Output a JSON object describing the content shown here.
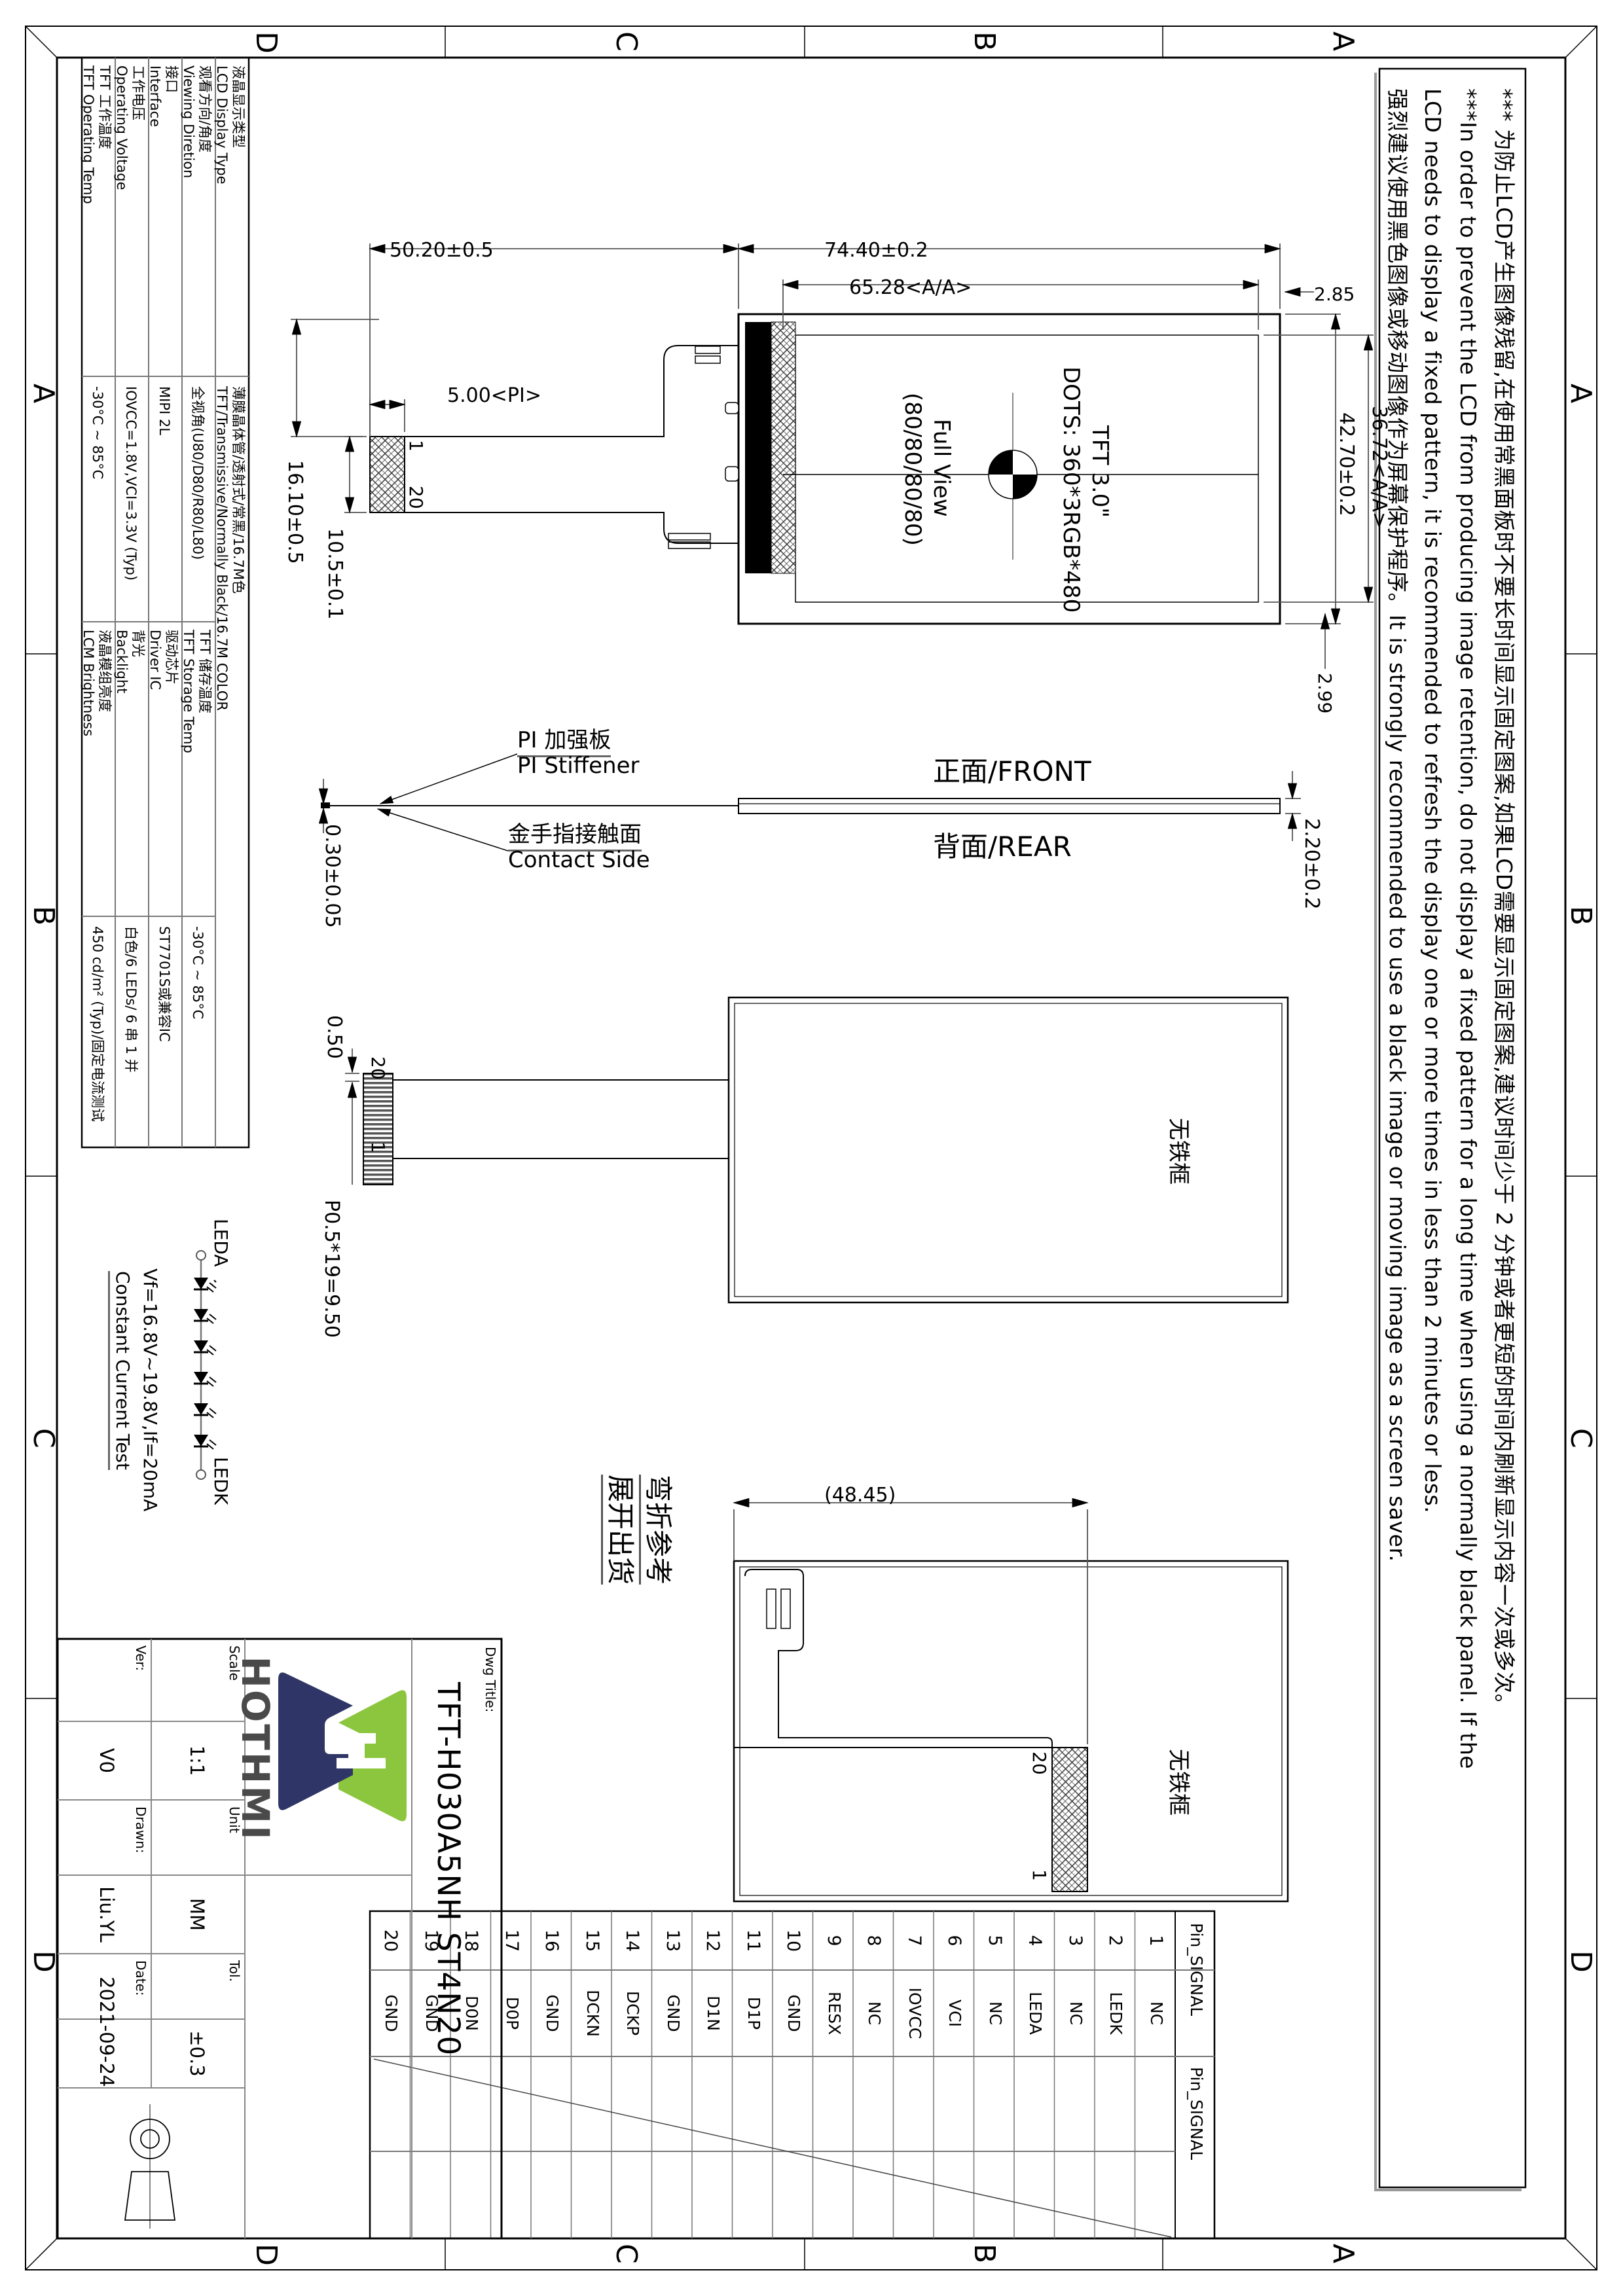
{
  "zones": {
    "z1": "A",
    "z2": "B",
    "z3": "C",
    "z4": "D"
  },
  "note": {
    "line1": "*** 为防止LCD产生图像残留,在使用常黑面板时不要长时间显示固定图案,如果LCD需要显示固定图案,建议时间少于 2 分钟或者更短的时间内刷新显示内容一次或多次。",
    "line2": "***In order to prevent the LCD from producing image retention, do not display a fixed pattern for a long time when using a normally black panel. If the",
    "line3": "LCD needs to display a fixed pattern, it is recommended to refresh the display one or more times in less than 2 minutes or less.",
    "line4": "强烈建议使用黑色图像或移动图像作为屏幕保护程序。It is strongly recommended to use a black image or moving image as a screen saver."
  },
  "specs": {
    "r1": {
      "l_cn": "液晶显示类型",
      "l_en": "LCD Display Type",
      "v_cn": "薄膜晶体管/透射式/常黑/16.7M色",
      "v_en": "TFT/Transmissive/Normally Black/16.7M COLOR"
    },
    "r2": {
      "l_cn": "观看方向/角度",
      "l_en": "Viewing Diretion",
      "v": "全视角(U80/D80/R80/L80)",
      "l2_cn": "TFT 储存温度",
      "l2_en": "TFT Storage Temp",
      "v2": "-30°C ~ 85°C"
    },
    "r3": {
      "l_cn": "接口",
      "l_en": "Interface",
      "v": "MIPI 2L",
      "l2_cn": "驱动芯片",
      "l2_en": "Driver IC",
      "v2": "ST7701S或兼容IC"
    },
    "r4": {
      "l_cn": "工作电压",
      "l_en": "Operating Voltage",
      "v": "IOVCC=1.8V,VCI=3.3V (Typ)",
      "l2_cn": "背光",
      "l2_en": "Backlight",
      "v2": "白色/6 LEDs/ 6 串 1 并"
    },
    "r5": {
      "l_cn": "TFT 工作温度",
      "l_en": "TFT Operating Temp",
      "v": "-30°C ~ 85°C",
      "l2_cn": "液晶模组亮度",
      "l2_en": "LCM Brightness",
      "v2": "450 cd/m² (Typ)/固定电流测试"
    }
  },
  "dims": {
    "d5020": "50.20±0.5",
    "d7440": "74.40±0.2",
    "d6528": "65.28<A/A>",
    "d285": "2.85",
    "d4270": "42.70±0.2",
    "d3672": "36.72<A/A>",
    "d299": "2.99",
    "d1610": "16.10±0.5",
    "d105": "10.5±0.1",
    "d500": "5.00<PI>",
    "d030": "0.30±0.05",
    "d220": "2.20±0.2",
    "d050": "0.50",
    "pitch": "P0.5*19=9.50",
    "d4845": "(48.45)"
  },
  "front": {
    "tft": "TFT 3.0\"",
    "dots": "DOTS: 360*3RGB*480",
    "fv1": "Full View",
    "fv2": "(80/80/80/80)",
    "pin1": "1",
    "pin20": "20"
  },
  "side": {
    "pi_cn": "PI 加强板",
    "pi_en": "PI Stiffener",
    "contact_cn": "金手指接触面",
    "contact_en": "Contact Side",
    "front": "正面/FRONT",
    "rear": "背面/REAR"
  },
  "rear": {
    "no_frame": "无铁框",
    "p20": "20",
    "p1": "1"
  },
  "unfold": {
    "no_frame": "无铁框",
    "bend1": "弯折参考",
    "bend2": "展开出货",
    "p20": "20",
    "p1": "1"
  },
  "led": {
    "a": "LEDA",
    "k": "LEDK",
    "vf": "Vf=16.8V~19.8V,If=20mA",
    "cct": "Constant Current Test"
  },
  "pin_table": {
    "header1": "Pin_SIGNAL",
    "header2": "Pin_SIGNAL",
    "pins": [
      {
        "no": "1",
        "signal": "NC"
      },
      {
        "no": "2",
        "signal": "LEDK"
      },
      {
        "no": "3",
        "signal": "NC"
      },
      {
        "no": "4",
        "signal": "LEDA"
      },
      {
        "no": "5",
        "signal": "NC"
      },
      {
        "no": "6",
        "signal": "VCI"
      },
      {
        "no": "7",
        "signal": "IOVCC"
      },
      {
        "no": "8",
        "signal": "NC"
      },
      {
        "no": "9",
        "signal": "RESX"
      },
      {
        "no": "10",
        "signal": "GND"
      },
      {
        "no": "11",
        "signal": "D1P"
      },
      {
        "no": "12",
        "signal": "D1N"
      },
      {
        "no": "13",
        "signal": "GND"
      },
      {
        "no": "14",
        "signal": "DCKP"
      },
      {
        "no": "15",
        "signal": "DCKN"
      },
      {
        "no": "16",
        "signal": "GND"
      },
      {
        "no": "17",
        "signal": "D0P"
      },
      {
        "no": "18",
        "signal": "D0N"
      },
      {
        "no": "19",
        "signal": "GND"
      },
      {
        "no": "20",
        "signal": "GND"
      }
    ]
  },
  "title_block": {
    "dwg_title_label": "Dwg Title:",
    "title": "TFT-H030A5NH ST4N20",
    "scale_label": "Scale",
    "scale": "1:1",
    "unit_label": "Unit",
    "unit": "MM",
    "tol_label": "Tol.",
    "tol": "±0.3",
    "ver_label": "Ver:",
    "ver": "V0",
    "drawn_label": "Drawn:",
    "drawn": "Liu.YL",
    "date_label": "Date:",
    "date": "2021-09-24",
    "logo_text": "HOTHMI",
    "logo_green": "#8CC63F",
    "logo_navy": "#2F3566"
  }
}
